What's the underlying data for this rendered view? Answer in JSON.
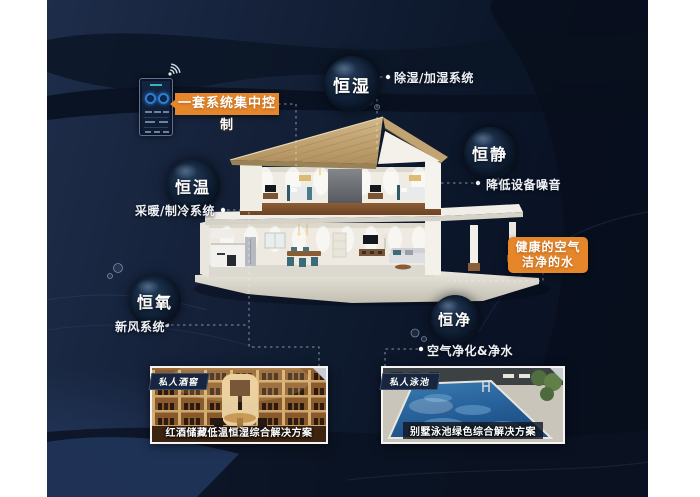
{
  "control": {
    "label": "一套系统集中控制"
  },
  "features": [
    {
      "id": "heng-shi",
      "label": "恒湿",
      "desc": "除湿/加湿系统"
    },
    {
      "id": "heng-jing",
      "label": "恒静",
      "desc": "降低设备噪音"
    },
    {
      "id": "heng-wen",
      "label": "恒温",
      "desc": "采暖/制冷系统"
    },
    {
      "id": "heng-yang",
      "label": "恒氧",
      "desc": "新风系统"
    },
    {
      "id": "heng-jin",
      "label": "恒净",
      "desc": "空气净化&净水"
    }
  ],
  "highlight": {
    "line1": "健康的空气",
    "line2": "洁净的水"
  },
  "photos": [
    {
      "tag": "私人酒窖",
      "caption": "红酒储藏低温恒湿综合解决方案"
    },
    {
      "tag": "私人泳池",
      "caption": "别墅泳池绿色综合解决方案"
    }
  ],
  "icons": {
    "wifi": "wifi-icon",
    "phone": "smartphone-control-app"
  },
  "colors": {
    "accent_orange": "#e5862b",
    "background_navy": "#0d1a2e",
    "roof_tan": "#c4a675",
    "pool_blue": "#2f71ab",
    "photo_tag_bg": "#17263e",
    "bubble_text": "#ffffff"
  }
}
